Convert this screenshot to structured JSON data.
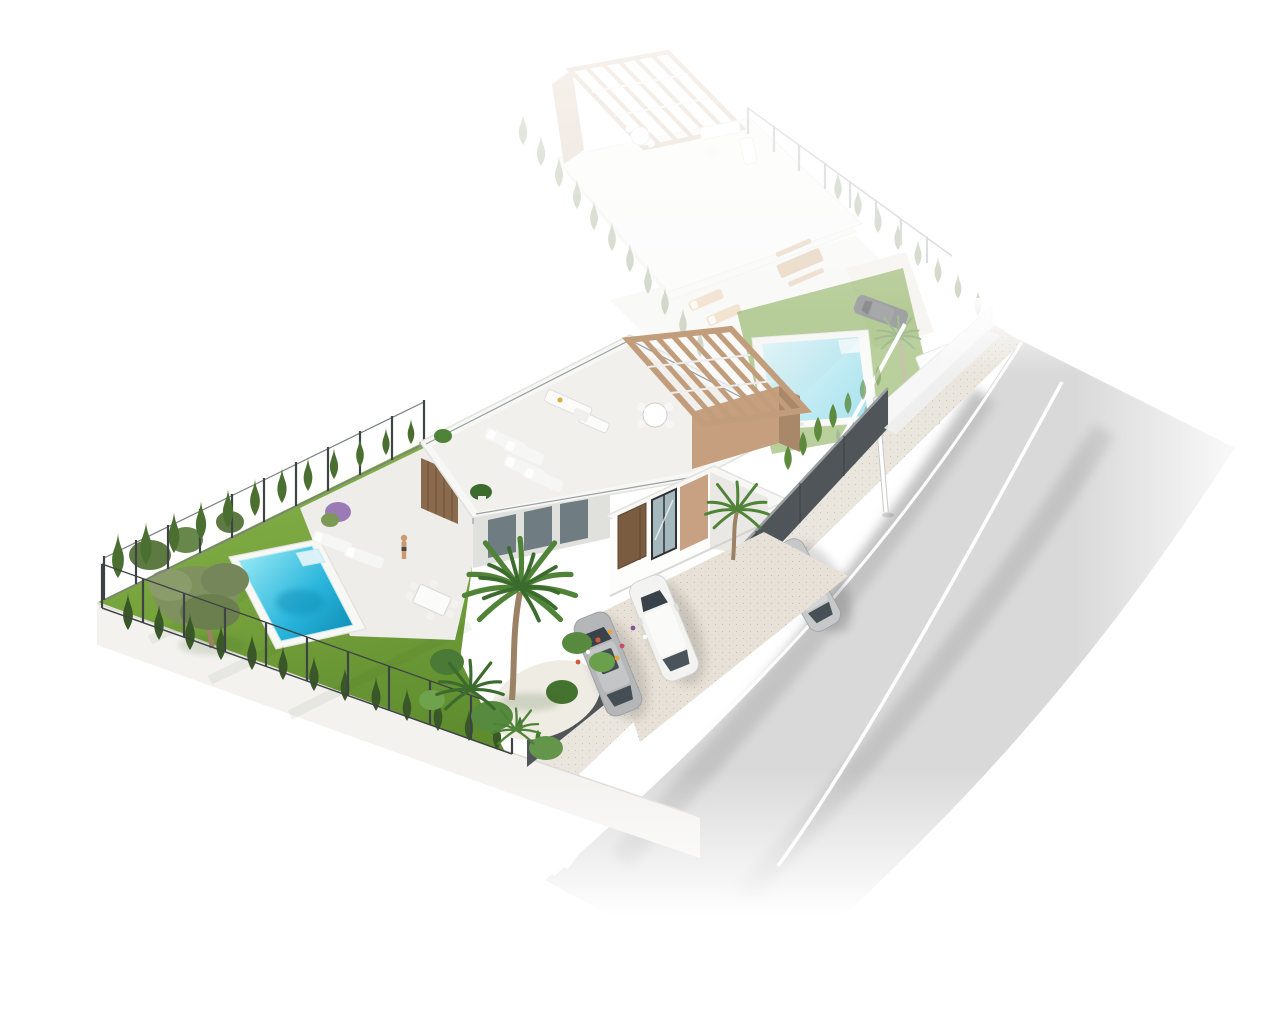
{
  "scene": {
    "kind": "3d-aerial-architectural-render",
    "subject": "Modern single-storey villa plot with rooftop terrace, pergola, pool and garden; faded twin villa plot behind; street with passing car",
    "background": "#ffffff"
  },
  "palette": {
    "bg": "#ffffff",
    "lawn": "#76a33c",
    "lawn_dark": "#5f8c2e",
    "lawn_light": "#86b14a",
    "cypress": "#4b6e31",
    "cypress_dark": "#3a5827",
    "hedge": "#5d8a3c",
    "shrub": "#49773a",
    "olive": "#7f915f",
    "olive_dark": "#6b7f4e",
    "trunk": "#9b8265",
    "palm": "#4f8338",
    "palm_dark": "#3b6b2d",
    "pool_light": "#8ce4f2",
    "pool_mid": "#2ab5dc",
    "pool_deep": "#0e8cb4",
    "pool_coping": "#f7f7f4",
    "patio": "#eeedea",
    "roof": "#f7f7f5",
    "roof_floor": "#f1f0ed",
    "edge": "#e3e2de",
    "wall": "#fdfdfc",
    "wall_shade": "#e9e8e4",
    "recess": "#e0e0dd",
    "wood_panel": "#8a6b4e",
    "pergola": "#c29d7c",
    "pergola_wall": "#c69f7f",
    "pergola_dark": "#a9886a",
    "door": "#7a5c40",
    "window_frame": "#2f3133",
    "glass": "#5a6a72",
    "glass_light": "#a4b8be",
    "accent_panel": "#c8a183",
    "fence_dark": "#50555a",
    "fence_cap": "#9aa0a4",
    "fence_metal": "#3e4346",
    "rail": "#7a7f83",
    "plinth": "#f3f2ef",
    "plinth_edge": "#dcdbd6",
    "driveway": "#e7e1d7",
    "pebbles": "#efece4",
    "speck": "#bfb7a6",
    "sidewalk": "#eae6de",
    "asphalt": "#d9d9d9",
    "asphalt_dark": "#c3c3c3",
    "road_line": "#ffffff",
    "car_white": "#f3f3f1",
    "car_gray": "#b4b6b8",
    "car_silver": "#c7c8ca",
    "car_dark": "#4b4f54",
    "car_window": "#39424a",
    "ghost_wall": "#eef0ef",
    "skin": "#c9996f",
    "furniture_white": "#f6f6f4",
    "furniture_tan": "#d9a86c",
    "table_wood": "#c08a4f",
    "flower_red": "#d4593a",
    "flower_orange": "#e8a23c",
    "flower_purple": "#8a52a0",
    "flower_pink": "#c94b6e",
    "flower_white": "#ffffff",
    "lilac": "#9a7bb5"
  },
  "main_plot": {
    "pool": {
      "shape": "rectangular",
      "steps": "corner-roman-steps",
      "deck": "white coping"
    },
    "garden": {
      "cypress_left_row": 12,
      "cypress_bottom_row": 13,
      "olive_trees": 1,
      "palm_trees": 3,
      "flower_bed": true
    },
    "house": {
      "storeys": 1,
      "roof_terrace": true,
      "pergola_slats": 6,
      "sun_loungers_roof": 4,
      "round_table_chairs": 4,
      "outdoor_sofa": true,
      "front_door": "wood",
      "accent": "tan stucco"
    },
    "driveway": {
      "parked_cars": 2,
      "fence": "dark slat panels"
    },
    "terrace": {
      "loungers": 2,
      "dining_table_chairs": 6,
      "person": 1
    }
  },
  "ghost_plot": {
    "state": "faded-future-phase",
    "pool": true,
    "pergola_slats": 5,
    "parked_car": 1,
    "dining_set": true,
    "loungers": 2,
    "hedge_rows": 2,
    "palm_trees": 1,
    "storage_box": true
  },
  "street": {
    "lane_lines": 2,
    "driving_cars": 1,
    "lamp_post": 1,
    "sidewalk": true
  }
}
